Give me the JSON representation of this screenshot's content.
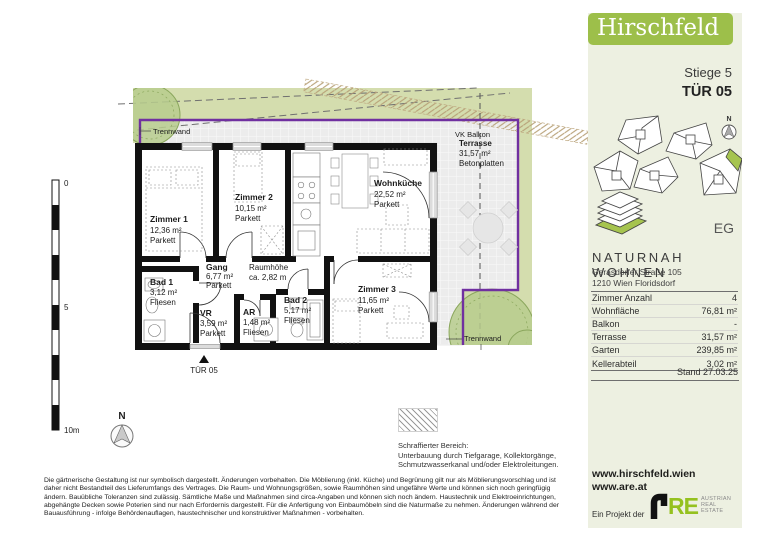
{
  "header": {
    "brand": "Hirschfeld",
    "stiege": "Stiege 5",
    "tuer": "TÜR 05"
  },
  "sidebar": {
    "floor_label": "EG",
    "compass_label": "N",
    "project": {
      "name": "NATURNAH WOHNEN",
      "address_line1": "Gerasdorfer Straße 105",
      "address_line2": "1210 Wien Floridsdorf"
    },
    "facts": {
      "rows": [
        {
          "label": "Zimmer Anzahl",
          "value": "4"
        },
        {
          "label": "Wohnfläche",
          "value": "76,81 m²"
        },
        {
          "label": "Balkon",
          "value": "-"
        },
        {
          "label": "Terrasse",
          "value": "31,57 m²"
        },
        {
          "label": "Garten",
          "value": "239,85 m²"
        },
        {
          "label": "Kellerabteil",
          "value": "3,02 m²"
        }
      ]
    },
    "stand": "Stand 27.03.25",
    "links": [
      "www.hirschfeld.wien",
      "www.are.at"
    ],
    "project_of": "Ein Projekt der",
    "are": {
      "mark_text": "RE",
      "caption": [
        "AUSTRIAN",
        "REAL",
        "ESTATE"
      ]
    }
  },
  "plan": {
    "rooms": [
      {
        "name": "Zimmer 1",
        "area": "12,36 m²",
        "floor": "Parkett"
      },
      {
        "name": "Zimmer 2",
        "area": "10,15 m²",
        "floor": "Parkett"
      },
      {
        "name": "Wohnküche",
        "area": "22,52 m²",
        "floor": "Parkett"
      },
      {
        "name": "Gang",
        "area": "6,77 m²",
        "floor": "Parkett"
      },
      {
        "name": "Bad 1",
        "area": "3,12 m²",
        "floor": "Fliesen"
      },
      {
        "name": "VR",
        "area": "3,59 m²",
        "floor": "Parkett"
      },
      {
        "name": "AR",
        "area": "1,48 m²",
        "floor": "Fliesen"
      },
      {
        "name": "Bad 2",
        "area": "5,17 m²",
        "floor": "Fliesen"
      },
      {
        "name": "Zimmer 3",
        "area": "11,65 m²",
        "floor": "Parkett"
      }
    ],
    "terrace": {
      "name": "Terrasse",
      "area": "31,57 m²",
      "surface": "Betonplatten"
    },
    "labels": {
      "trennwand_top": "Trennwand",
      "trennwand_bottom": "Trennwand",
      "vk_balkon": "VK Balkon",
      "raumhoehe_line1": "Raumhöhe",
      "raumhoehe_line2": "ca. 2,82 m",
      "entrance": "TÜR 05",
      "north": "N"
    },
    "scalebar": {
      "start": "0",
      "mid": "5",
      "end": "10m"
    }
  },
  "legend": {
    "title": "Schraffierter Bereich:",
    "lines": [
      "Unterbauung durch Tiefgarage, Kollektorgänge,",
      "Schmutzwasserkanal und/oder Elektroleitungen."
    ]
  },
  "disclaimer": {
    "lines": [
      "Die gärtnerische Gestaltung ist nur symbolisch dargestellt. Änderungen vorbehalten. Die Möblierung (inkl. Küche) und Begrünung gilt nur als Möblierungsvorschlag und ist",
      "daher nicht Bestandteil des Lieferumfangs des Vertrages. Die Raum- und Wohnungsgrößen, sowie Raumhöhen sind ungefähre Werte und können sich noch geringfügig",
      "ändern. Bauübliche Toleranzen sind zulässig. Sämtliche Maße und Maßnahmen sind circa-Angaben und können sich noch ändern. Haustechnik und Elektroeinrichtungen,",
      "abgehängte Decken sowie Poterien sind nur nach Erfordernis dargestellt. Für die Anfertigung von Einbaumöbeln sind die Naturmaße zu nehmen. Änderungen während der",
      "Bauausführung - infolge Behördenauflagen, haustechnischer und konstruktiver Maßnahmen - vorbehalten."
    ]
  },
  "colors": {
    "banner_green": "#9dbf4a",
    "are_green": "#95c11f",
    "garden_green": "#d4ddae",
    "boundary_purple": "#7030a0"
  }
}
